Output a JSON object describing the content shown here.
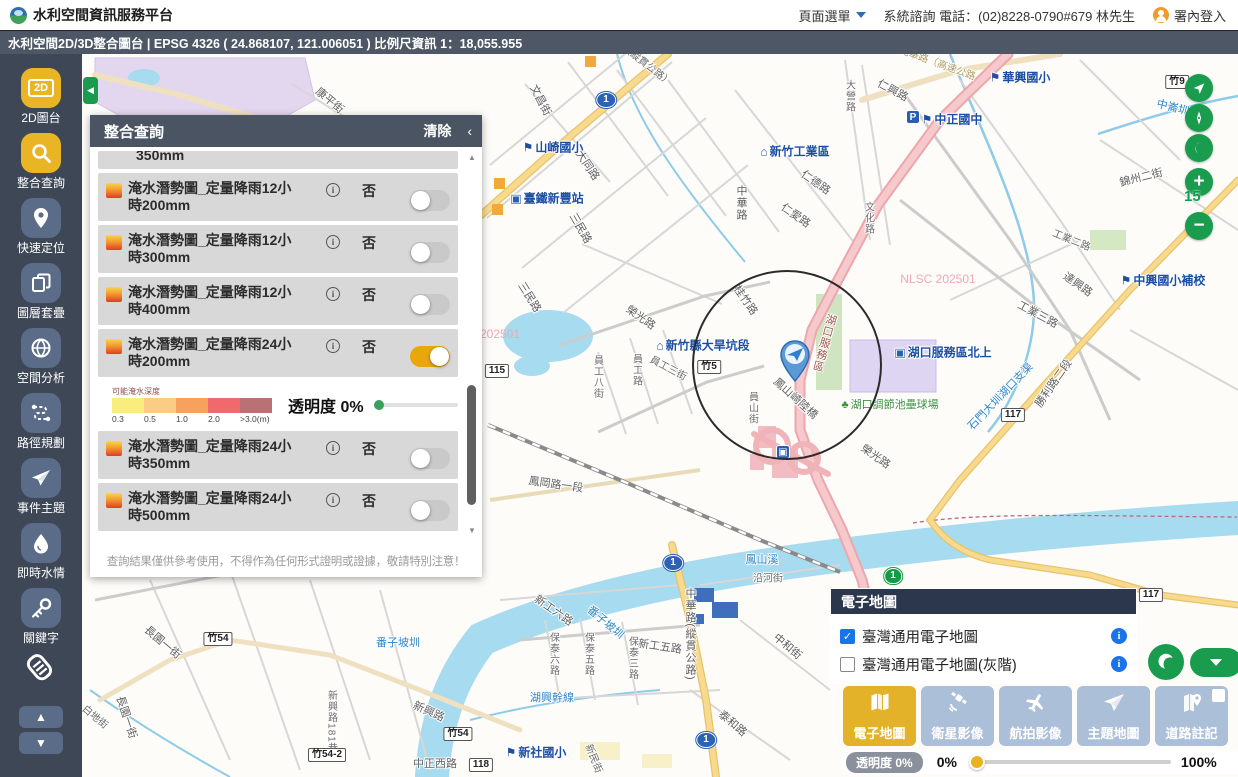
{
  "header": {
    "title": "水利空間資訊服務平台",
    "menu_label": "頁面選單",
    "contact": "系統諮詢 電話：(02)8228-0790#679 林先生",
    "login": "署內登入"
  },
  "titlebar": {
    "text": "水利空間2D/3D整合圖台 | EPSG 4326 ( 24.868107, 121.006051 ) 比例尺資訊 1：18,055.955"
  },
  "sidebar": {
    "items": [
      {
        "label": "2D圖台",
        "icon": "2d-map-icon",
        "active": true
      },
      {
        "label": "整合查詢",
        "icon": "search-icon",
        "active": true
      },
      {
        "label": "快速定位",
        "icon": "location-pin-icon",
        "active": false
      },
      {
        "label": "圖層套疊",
        "icon": "layers-icon",
        "active": false
      },
      {
        "label": "空間分析",
        "icon": "globe-icon",
        "active": false
      },
      {
        "label": "路徑規劃",
        "icon": "route-icon",
        "active": false
      },
      {
        "label": "事件主題",
        "icon": "paper-plane-icon",
        "active": false
      },
      {
        "label": "即時水情",
        "icon": "water-drop-icon",
        "active": false
      },
      {
        "label": "關鍵字",
        "icon": "key-icon",
        "active": false
      }
    ]
  },
  "query_panel": {
    "title": "整合查詢",
    "clear_label": "清除",
    "collapse_icon": "‹",
    "partial_row_text": "350mm",
    "rows": [
      {
        "line1": "淹水潛勢圖_定量降雨12小",
        "line2": "時200mm",
        "flag": "否",
        "on": false,
        "legend_after": false
      },
      {
        "line1": "淹水潛勢圖_定量降雨12小",
        "line2": "時300mm",
        "flag": "否",
        "on": false,
        "legend_after": false
      },
      {
        "line1": "淹水潛勢圖_定量降雨12小",
        "line2": "時400mm",
        "flag": "否",
        "on": false,
        "legend_after": false
      },
      {
        "line1": "淹水潛勢圖_定量降雨24小",
        "line2": "時200mm",
        "flag": "否",
        "on": true,
        "legend_after": true
      },
      {
        "line1": "淹水潛勢圖_定量降雨24小",
        "line2": "時350mm",
        "flag": "否",
        "on": false,
        "legend_after": false
      },
      {
        "line1": "淹水潛勢圖_定量降雨24小",
        "line2": "時500mm",
        "flag": "否",
        "on": false,
        "legend_after": false
      }
    ],
    "legend": {
      "title": "可能淹水深度",
      "colors": [
        "#f9ee7d",
        "#fbcc85",
        "#f6a25e",
        "#f0696c",
        "#b97173"
      ],
      "ticks": [
        "0.3",
        "0.5",
        "1.0",
        "2.0",
        ">3.0(m)"
      ],
      "opacity_label": "透明度 0%"
    },
    "disclaimer": "查詢結果僅供參考使用，不得作為任何形式證明或證據，敬請特別注意！"
  },
  "map": {
    "controls": {
      "zoom_level": "15"
    },
    "labels": [
      {
        "t": "文昌街",
        "x": 541,
        "y": 100,
        "r": 62,
        "c": "road"
      },
      {
        "t": "（縱貫公路）",
        "x": 648,
        "y": 64,
        "r": 38,
        "c": "roadsm"
      },
      {
        "t": "大同路",
        "x": 588,
        "y": 165,
        "r": 56,
        "c": "road"
      },
      {
        "t": "山崎國小",
        "x": 553,
        "y": 147,
        "c": "poi",
        "icon": "school"
      },
      {
        "t": "臺鐵新豐站",
        "x": 547,
        "y": 198,
        "c": "poi",
        "icon": "train"
      },
      {
        "t": "三民路",
        "x": 581,
        "y": 228,
        "r": 60,
        "c": "road"
      },
      {
        "t": "新竹工業區",
        "x": 795,
        "y": 151,
        "c": "poi",
        "icon": "factory"
      },
      {
        "t": "中華路",
        "x": 741,
        "y": 203,
        "v": 1,
        "c": "road"
      },
      {
        "t": "仁德路",
        "x": 816,
        "y": 182,
        "r": 35,
        "c": "road"
      },
      {
        "t": "仁愛路",
        "x": 796,
        "y": 215,
        "r": 35,
        "c": "road"
      },
      {
        "t": "文化路",
        "x": 868,
        "y": 218,
        "v": 1,
        "c": "roadsm"
      },
      {
        "t": "大營路",
        "x": 849,
        "y": 96,
        "v": 1,
        "c": "roadsm"
      },
      {
        "t": "仁興路",
        "x": 893,
        "y": 90,
        "r": 28,
        "c": "road"
      },
      {
        "t": "光華路（高速公路",
        "x": 938,
        "y": 62,
        "r": 20,
        "c": "tan"
      },
      {
        "t": "華興國小",
        "x": 1020,
        "y": 77,
        "c": "poi",
        "icon": "school"
      },
      {
        "t": "中正國中",
        "x": 952,
        "y": 119,
        "c": "poi",
        "icon": "school"
      },
      {
        "t": "中崙圳",
        "x": 1173,
        "y": 107,
        "r": 14,
        "c": "water"
      },
      {
        "t": "錦州二街",
        "x": 1141,
        "y": 177,
        "r": -14,
        "c": "road"
      },
      {
        "t": "康平街",
        "x": 330,
        "y": 100,
        "r": 40,
        "c": "road"
      },
      {
        "t": "桂竹路",
        "x": 746,
        "y": 300,
        "r": 55,
        "c": "road"
      },
      {
        "t": "新竹縣大旱坑段",
        "x": 703,
        "y": 345,
        "c": "poi",
        "icon": "building"
      },
      {
        "t": "榮光路",
        "x": 641,
        "y": 317,
        "r": 35,
        "c": "road"
      },
      {
        "t": "三民路",
        "x": 530,
        "y": 297,
        "r": 58,
        "c": "road"
      },
      {
        "t": "員工路",
        "x": 636,
        "y": 370,
        "v": 1,
        "c": "roadsm"
      },
      {
        "t": "員工八街",
        "x": 597,
        "y": 377,
        "v": 1,
        "c": "roadsm"
      },
      {
        "t": "員工三街",
        "x": 669,
        "y": 367,
        "r": 28,
        "c": "roadsm"
      },
      {
        "t": "湖口服務區",
        "x": 824,
        "y": 343,
        "v": 1,
        "r": 15,
        "c": "brown"
      },
      {
        "t": "湖口服務區北上",
        "x": 943,
        "y": 352,
        "c": "poi",
        "icon": "bus"
      },
      {
        "t": "湖口調節池壘球場",
        "x": 890,
        "y": 404,
        "c": "green",
        "icon": "tree"
      },
      {
        "t": "鳳山崎陸橋",
        "x": 796,
        "y": 398,
        "r": 42,
        "c": "road"
      },
      {
        "t": "員山街",
        "x": 752,
        "y": 408,
        "v": 1,
        "c": "roadsm"
      },
      {
        "t": "NLSC 202501",
        "x": 938,
        "y": 279,
        "c": "pink"
      },
      {
        "t": "202501",
        "x": 500,
        "y": 334,
        "c": "pink"
      },
      {
        "t": "鳳岡路一段",
        "x": 556,
        "y": 484,
        "r": 8,
        "c": "road"
      },
      {
        "t": "榮光路",
        "x": 876,
        "y": 456,
        "r": 35,
        "c": "road"
      },
      {
        "t": "鳳山溪",
        "x": 762,
        "y": 559,
        "c": "water"
      },
      {
        "t": "沿河街",
        "x": 768,
        "y": 577,
        "c": "roadsm"
      },
      {
        "t": "中華路(縱貫公路)",
        "x": 690,
        "y": 634,
        "v": 1,
        "c": "road"
      },
      {
        "t": "新工六路",
        "x": 554,
        "y": 610,
        "r": 35,
        "c": "road"
      },
      {
        "t": "新工五路",
        "x": 660,
        "y": 646,
        "r": 8,
        "c": "road"
      },
      {
        "t": "番子坡圳",
        "x": 606,
        "y": 622,
        "r": 40,
        "c": "water"
      },
      {
        "t": "保泰六路",
        "x": 553,
        "y": 654,
        "v": 1,
        "c": "roadsm"
      },
      {
        "t": "保泰五路",
        "x": 588,
        "y": 654,
        "v": 1,
        "c": "roadsm"
      },
      {
        "t": "保泰三路",
        "x": 632,
        "y": 658,
        "v": 1,
        "c": "roadsm"
      },
      {
        "t": "湖興幹線",
        "x": 552,
        "y": 697,
        "c": "water"
      },
      {
        "t": "新社國小",
        "x": 536,
        "y": 752,
        "c": "poi",
        "icon": "school"
      },
      {
        "t": "新民街",
        "x": 595,
        "y": 758,
        "r": 68,
        "c": "roadsm"
      },
      {
        "t": "泰和路",
        "x": 733,
        "y": 723,
        "r": 40,
        "c": "road"
      },
      {
        "t": "中和街",
        "x": 788,
        "y": 646,
        "r": 40,
        "c": "road"
      },
      {
        "t": "番子坡圳",
        "x": 398,
        "y": 642,
        "c": "water"
      },
      {
        "t": "長園一街",
        "x": 163,
        "y": 642,
        "r": 40,
        "c": "road"
      },
      {
        "t": "長園一街",
        "x": 127,
        "y": 717,
        "r": 72,
        "c": "road"
      },
      {
        "t": "白地街",
        "x": 96,
        "y": 716,
        "r": 40,
        "c": "roadsm"
      },
      {
        "t": "新興路181巷",
        "x": 331,
        "y": 722,
        "v": 1,
        "c": "roadsm"
      },
      {
        "t": "新興路",
        "x": 429,
        "y": 711,
        "r": 24,
        "c": "road"
      },
      {
        "t": "中正西路",
        "x": 435,
        "y": 763,
        "c": "road"
      },
      {
        "t": "中興國小補校",
        "x": 1163,
        "y": 280,
        "c": "poi",
        "icon": "school"
      },
      {
        "t": "達興路",
        "x": 1078,
        "y": 284,
        "r": 35,
        "c": "road"
      },
      {
        "t": "工業二路",
        "x": 1072,
        "y": 239,
        "r": 22,
        "c": "roadsm"
      },
      {
        "t": "工業三路",
        "x": 1038,
        "y": 314,
        "r": 28,
        "c": "road"
      },
      {
        "t": "石門大圳湖口支渠",
        "x": 1000,
        "y": 396,
        "r": -46,
        "c": "water"
      },
      {
        "t": "勝利路二段",
        "x": 1053,
        "y": 383,
        "r": -55,
        "c": "road"
      }
    ],
    "shields": [
      {
        "t": "1",
        "x": 606,
        "y": 100,
        "k": "blue"
      },
      {
        "t": "1",
        "x": 673,
        "y": 563,
        "k": "blue"
      },
      {
        "t": "1",
        "x": 706,
        "y": 740,
        "k": "blue"
      },
      {
        "t": "1",
        "x": 893,
        "y": 576,
        "k": "green"
      },
      {
        "t": "竹9",
        "x": 1177,
        "y": 82,
        "k": "white"
      },
      {
        "t": "竹5",
        "x": 709,
        "y": 367,
        "k": "white"
      },
      {
        "t": "115",
        "x": 497,
        "y": 371,
        "k": "white"
      },
      {
        "t": "竹54",
        "x": 218,
        "y": 639,
        "k": "white"
      },
      {
        "t": "竹54",
        "x": 458,
        "y": 734,
        "k": "white"
      },
      {
        "t": "竹54-2",
        "x": 327,
        "y": 755,
        "k": "white"
      },
      {
        "t": "118",
        "x": 481,
        "y": 765,
        "k": "white"
      },
      {
        "t": "117",
        "x": 1013,
        "y": 415,
        "k": "white"
      },
      {
        "t": "117",
        "x": 1151,
        "y": 595,
        "k": "white"
      }
    ],
    "poi_boxes": [
      {
        "t": "P",
        "x": 913,
        "y": 117,
        "name": "parking-icon"
      },
      {
        "t": "▣",
        "x": 783,
        "y": 452,
        "name": "rest-area-icon"
      }
    ]
  },
  "basemap_panel": {
    "title": "電子地圖",
    "options": [
      {
        "label": "臺灣通用電子地圖",
        "checked": true
      },
      {
        "label": "臺灣通用電子地圖(灰階)",
        "checked": false
      }
    ]
  },
  "basemap_buttons": [
    {
      "label": "電子地圖",
      "icon": "map-icon",
      "active": true,
      "has_checkbox": false
    },
    {
      "label": "衛星影像",
      "icon": "satellite-icon",
      "active": false,
      "has_checkbox": false
    },
    {
      "label": "航拍影像",
      "icon": "airplane-icon",
      "active": false,
      "has_checkbox": false
    },
    {
      "label": "主題地圖",
      "icon": "paper-plane-icon",
      "active": false,
      "has_checkbox": false
    },
    {
      "label": "道路註記",
      "icon": "road-pin-icon",
      "active": false,
      "has_checkbox": true
    }
  ],
  "opacity_bar": {
    "label": "透明度 0%",
    "min": "0%",
    "max": "100%"
  }
}
